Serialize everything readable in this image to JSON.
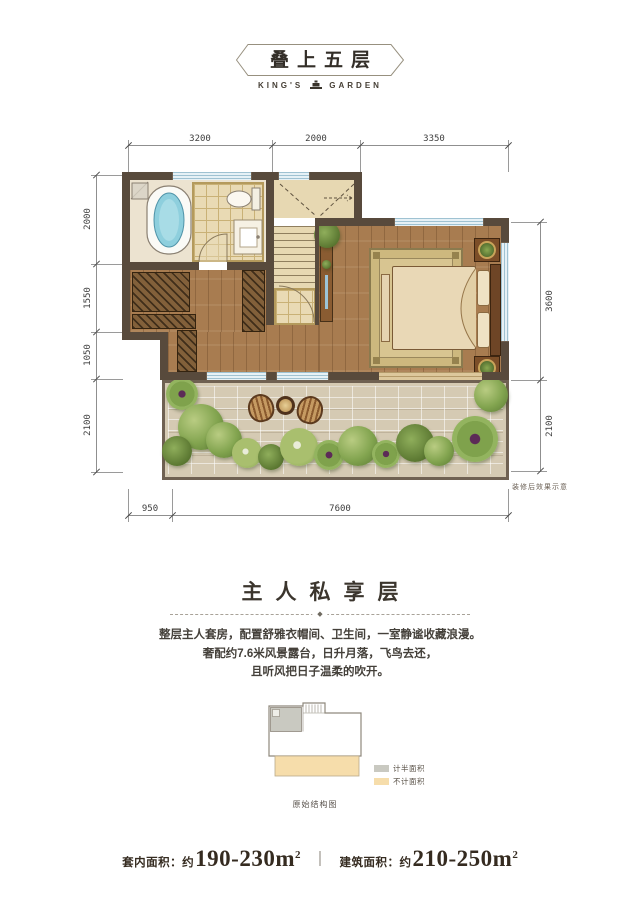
{
  "header": {
    "title": "叠上五层",
    "brand_left": "KING'S",
    "brand_right": "GARDEN"
  },
  "plan": {
    "dims_top": [
      "3200",
      "2000",
      "3350"
    ],
    "dims_left": [
      "2000",
      "1550",
      "1050",
      "2100"
    ],
    "dims_right": [
      "3600",
      "2100"
    ],
    "dims_bottom": [
      "950",
      "7600"
    ],
    "note": "装修后效果示意"
  },
  "section": {
    "title": "主人私享层",
    "ornament": "◆",
    "lines": [
      "整层主人套房，配置舒雅衣帽间、卫生间，一室静谧收藏浪漫。",
      "奢配约7.6米风景露台，日升月落，飞鸟去还，",
      "且听风把日子温柔的吹开。"
    ]
  },
  "structure": {
    "caption": "原始结构图",
    "legend": [
      {
        "label": "计半面积",
        "color": "#c9c9c1"
      },
      {
        "label": "不计面积",
        "color": "#f6ddab"
      }
    ]
  },
  "footer": {
    "left_label": "套内面积：约",
    "left_value": "190-230m",
    "sup": "2",
    "divider": "｜",
    "right_label": "建筑面积：约",
    "right_value": "210-250m"
  },
  "colors": {
    "wall": "#584a3c",
    "wood_floor": "#a87c50",
    "bath_tile": "#e9dab4",
    "marble": "#e7d8b2",
    "tub_water": "#8ecfdd",
    "window": "#d9ebf3",
    "paving": "#d5cab3",
    "plant_green": "#7fa24c",
    "rug": "#d6c291",
    "text_dark": "#352b20"
  }
}
